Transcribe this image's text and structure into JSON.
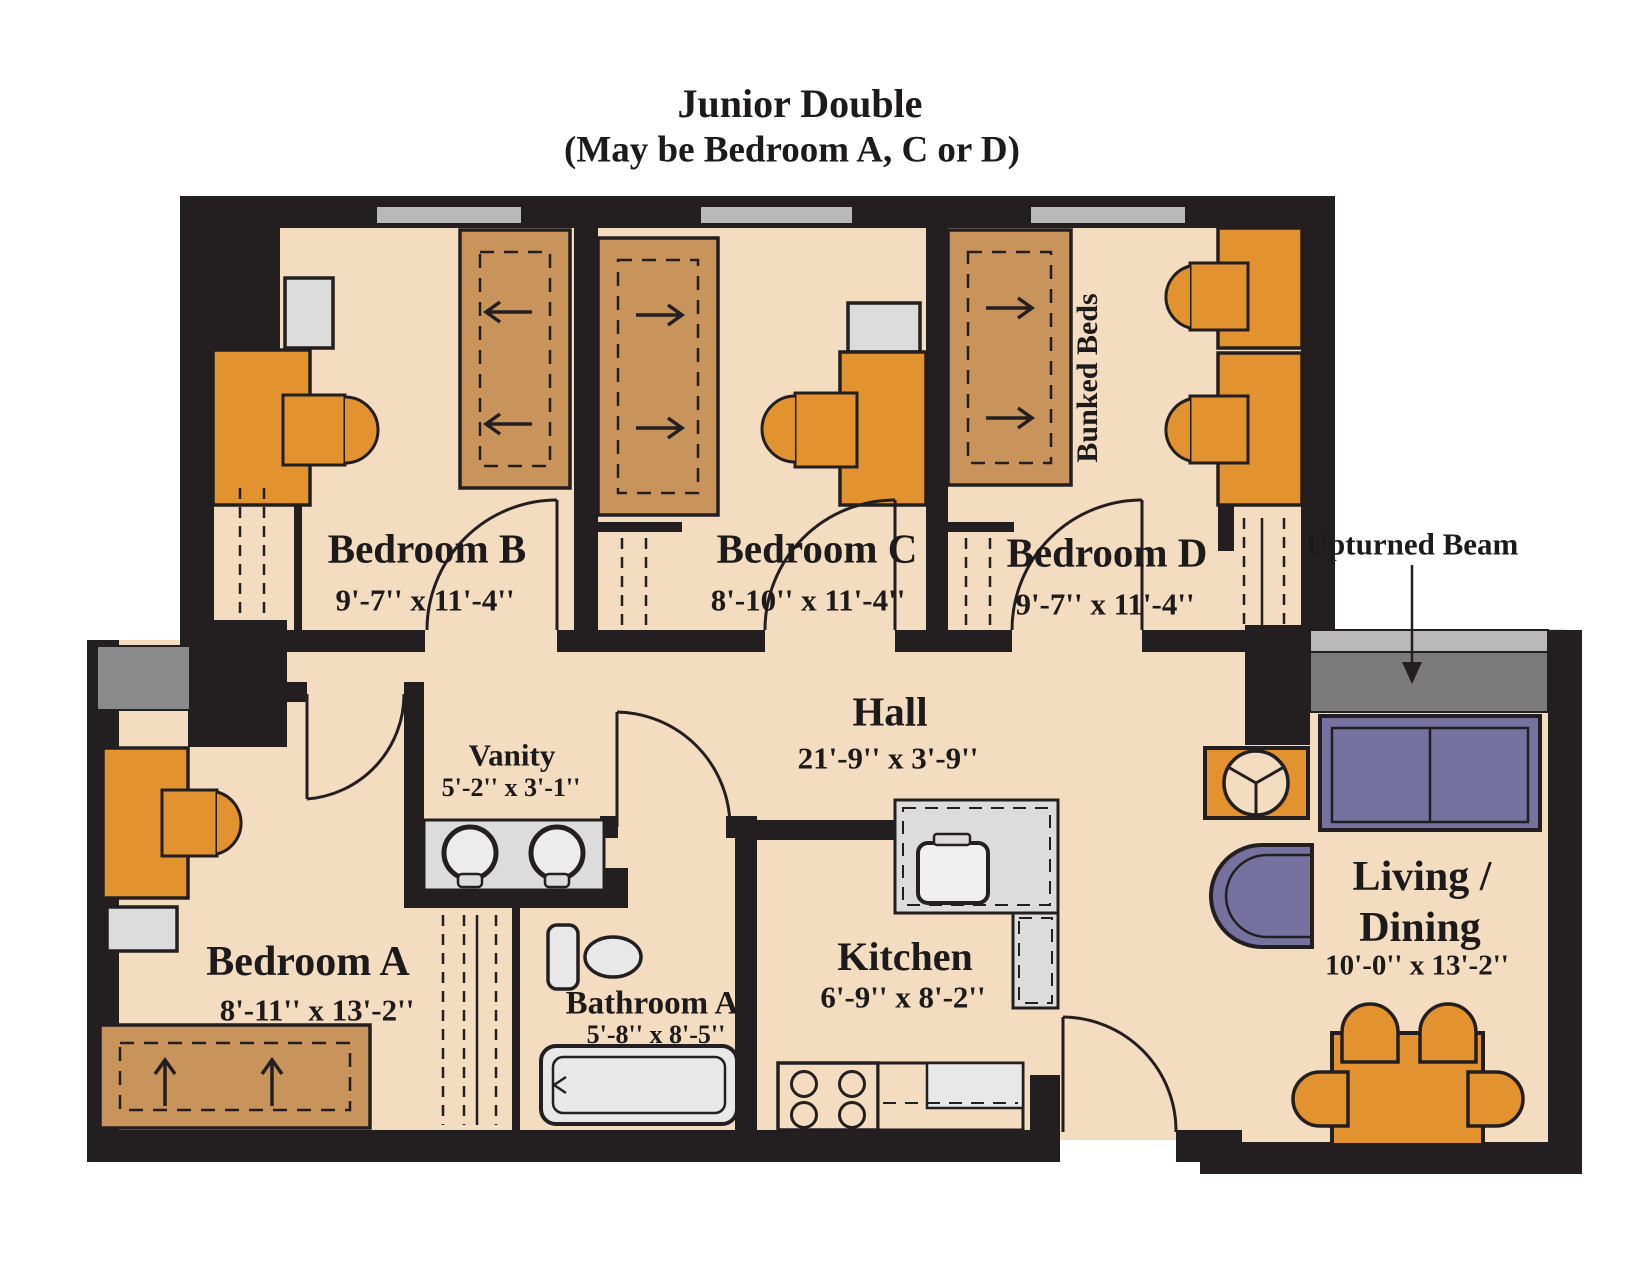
{
  "title": {
    "line1": "Junior Double",
    "line2": "(May be Bedroom A, C or D)"
  },
  "rooms": {
    "bedroom_b": {
      "name": "Bedroom B",
      "dims": "9'-7'' x 11'-4''"
    },
    "bedroom_c": {
      "name": "Bedroom C",
      "dims": "8'-10'' x 11'-4''"
    },
    "bedroom_d": {
      "name": "Bedroom D",
      "dims": "9'-7'' x 11'-4''"
    },
    "bedroom_a": {
      "name": "Bedroom A",
      "dims": "8'-11'' x 13'-2''"
    },
    "hall": {
      "name": "Hall",
      "dims": "21'-9'' x 3'-9''"
    },
    "vanity": {
      "name": "Vanity",
      "dims": "5'-2'' x 3'-1''"
    },
    "bathroom_a": {
      "name": "Bathroom A",
      "dims": "5'-8'' x 8'-5''"
    },
    "kitchen": {
      "name": "Kitchen",
      "dims": "6'-9'' x 8'-2''"
    },
    "living_dining": {
      "name_line1": "Living /",
      "name_line2": "Dining",
      "dims": "10'-0'' x 13'-2''"
    }
  },
  "annotations": {
    "bunked_beds": "Bunked Beds",
    "upturned_beam": "Upturned Beam"
  },
  "colors": {
    "wall": "#231f20",
    "floor": "#f3dcc0",
    "bed_brown": "#c9935c",
    "furniture_orange": "#e2922f",
    "fixture_gray": "#dcdcdc",
    "window_gray": "#b9b9b9",
    "beam_gray": "#7b7b7b",
    "sofa_purple": "#77719f"
  }
}
